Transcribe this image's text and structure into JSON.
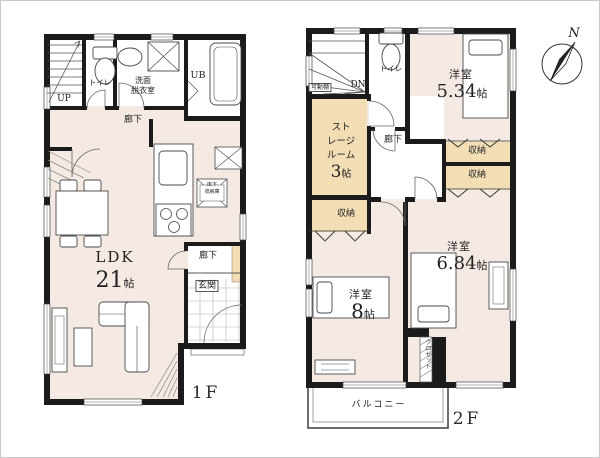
{
  "colors": {
    "wall": "#1b1b1b",
    "room_floor": "#f4eae3",
    "storage_fill": "#f2ddb5",
    "outline": "#555555"
  },
  "f1": {
    "floor_label": "1F",
    "stairs_up": "UP",
    "toilet": "トイレ",
    "washroom_line1": "洗面",
    "washroom_line2": "脱衣室",
    "unit_bath": "UB",
    "hallway_upper": "廊下",
    "ldk_name": "LDK",
    "ldk_size_num": "21",
    "ldk_size_unit": "帖",
    "underfloor_line1": "床下",
    "underfloor_line2": "収納庫",
    "hallway_lower": "廊下",
    "entrance": "玄関"
  },
  "f2": {
    "floor_label": "2F",
    "stairs_down": "DN",
    "movable_shelf": "可動棚",
    "toilet": "トイレ",
    "hallway": "廊下",
    "storage_line1": "スト",
    "storage_line2": "レージ",
    "storage_line3": "ルーム",
    "storage_size_num": "3",
    "storage_size_unit": "帖",
    "bedroom_a_name": "洋室",
    "bedroom_a_num": "5.34",
    "bedroom_a_unit": "帖",
    "closet_a": "収納",
    "closet_b": "収納",
    "closet_c": "収納",
    "bedroom_b_name": "洋室",
    "bedroom_b_num": "6.84",
    "bedroom_b_unit": "帖",
    "bedroom_c_name": "洋室",
    "bedroom_c_num": "8",
    "bedroom_c_unit": "帖",
    "closet_vertical": "クロゼット",
    "balcony": "バルコニー"
  },
  "compass": {
    "north": "N"
  }
}
